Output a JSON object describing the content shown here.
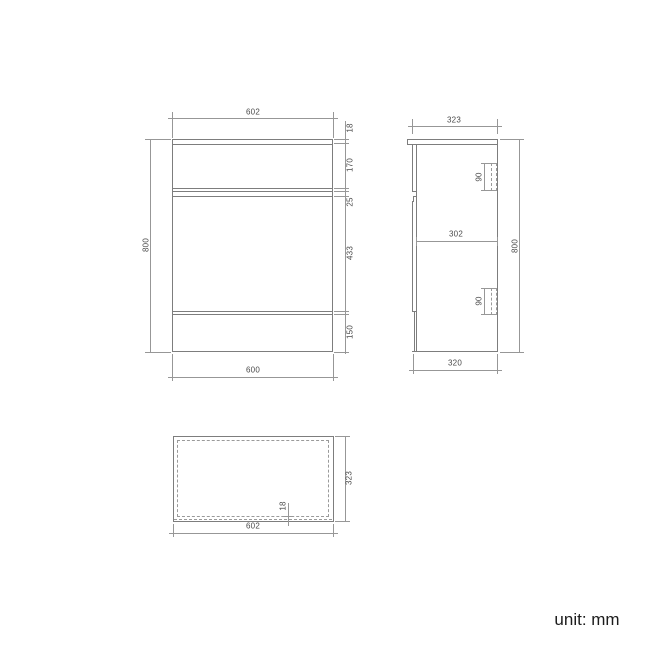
{
  "unit_label": "unit: mm",
  "front_view": {
    "width_top": "602",
    "top_thickness": "18",
    "drawer_height": "170",
    "gap": "25",
    "door_height": "433",
    "plinth_height": "150",
    "height": "800",
    "width_bottom": "600"
  },
  "side_view": {
    "depth_top": "323",
    "handle_upper": "90",
    "internal_depth": "302",
    "handle_lower": "90",
    "height": "800",
    "depth_bottom": "320"
  },
  "top_view": {
    "panel_thickness": "18",
    "depth": "323",
    "width": "602"
  },
  "colors": {
    "outline": "#7d7d7d",
    "dimension": "#979797",
    "label_text": "#4a4a4a"
  }
}
